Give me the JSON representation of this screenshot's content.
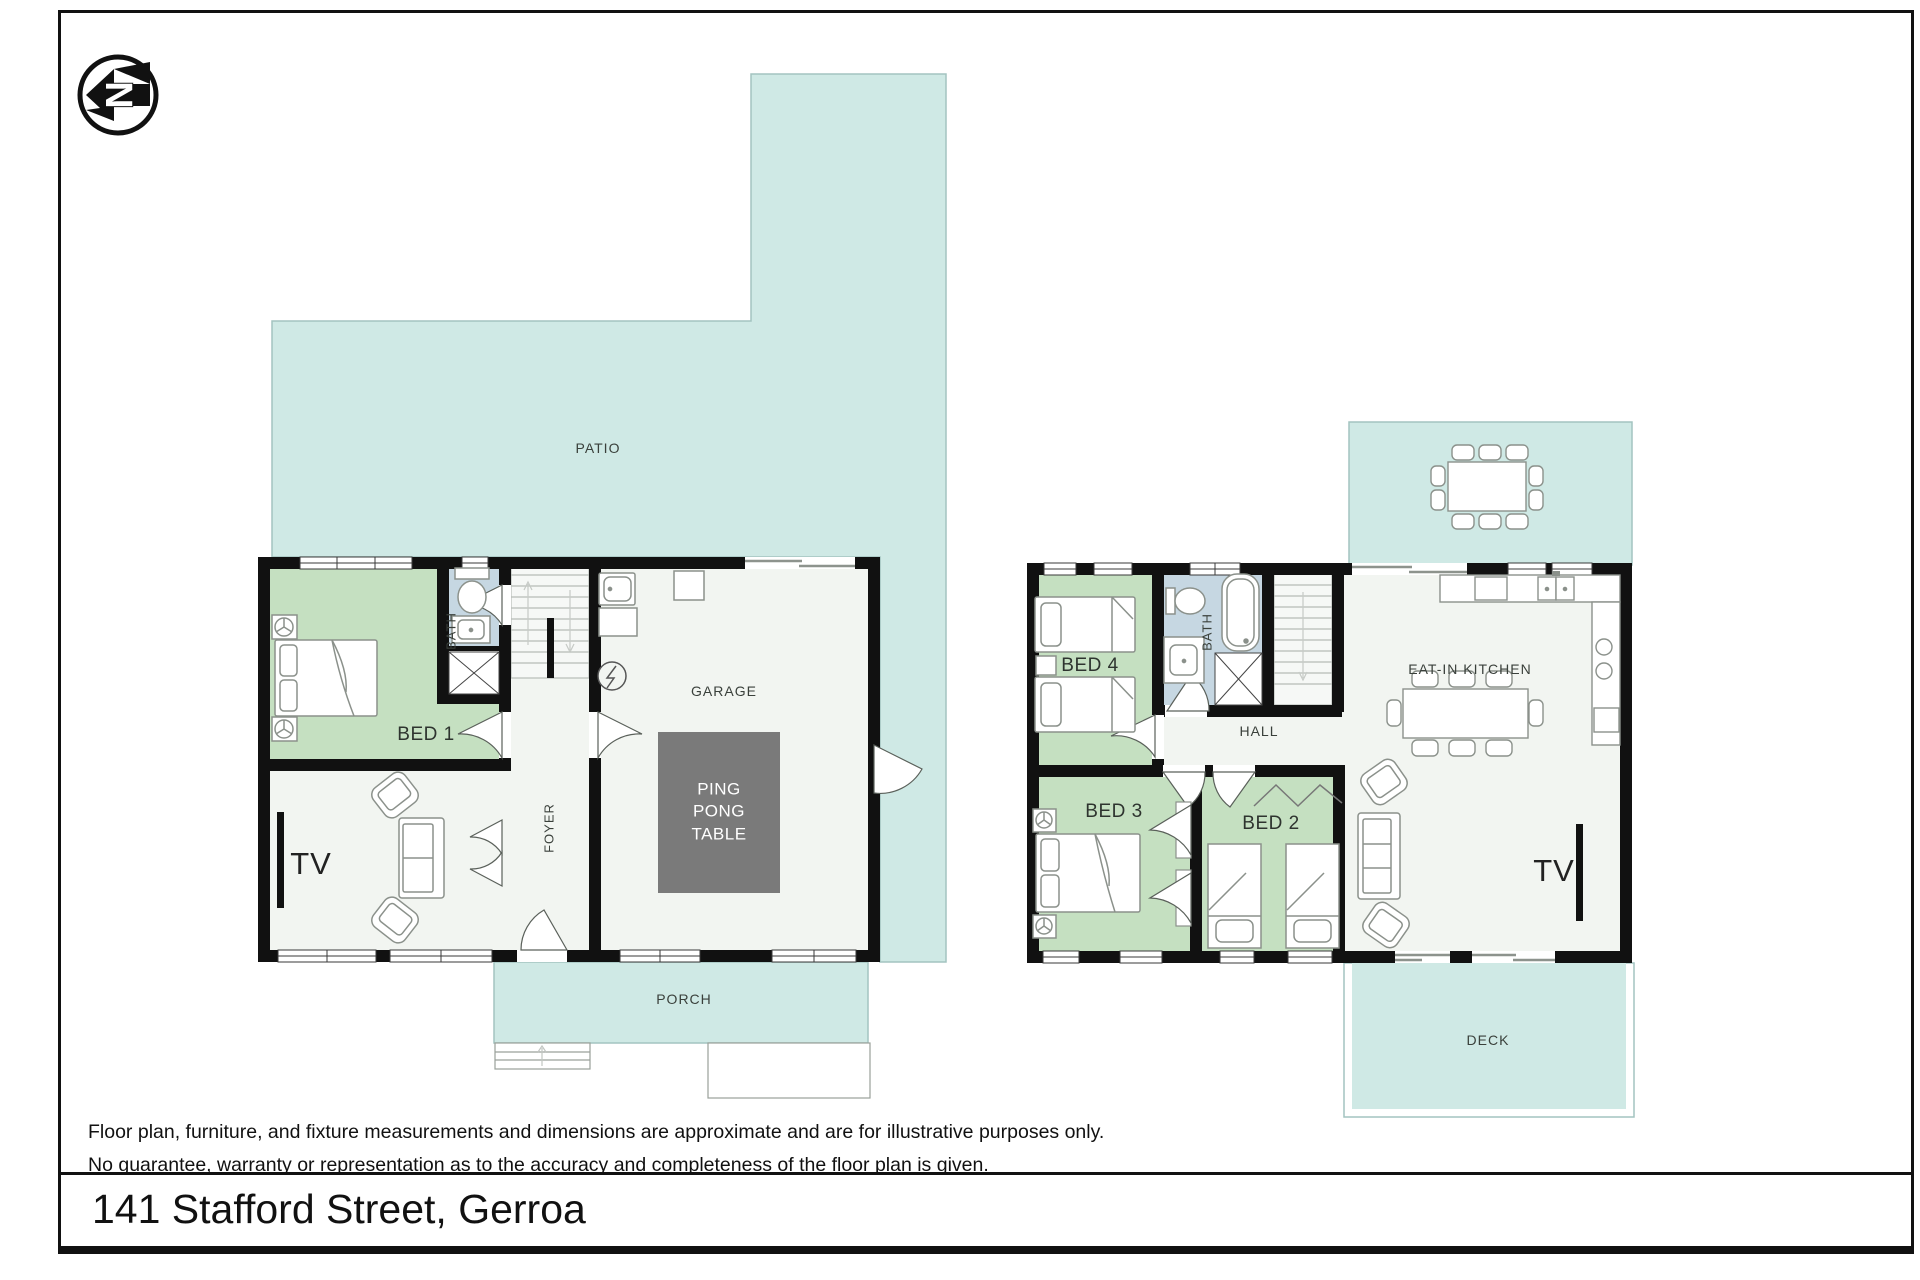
{
  "address": "141 Stafford Street, Gerroa",
  "disclaimer": {
    "line1": "Floor plan, furniture, and fixture measurements and dimensions are approximate and are for illustrative purposes only.",
    "line2": "No guarantee, warranty or representation as to the accuracy and completeness of the floor plan is given."
  },
  "compass": {
    "letter": "N"
  },
  "ground_floor": {
    "patio": "PATIO",
    "bed1": "BED 1",
    "bath": "BATH",
    "foyer": "FOYER",
    "garage": "GARAGE",
    "ping_pong_table": "PING PONG TABLE",
    "tv": "TV",
    "porch": "PORCH"
  },
  "upper_floor": {
    "bed4": "BED 4",
    "bath": "BATH",
    "hall": "HALL",
    "eat_in_kitchen": "EAT-IN KITCHEN",
    "bed3": "BED 3",
    "bed2": "BED 2",
    "tv": "TV",
    "deck": "DECK"
  },
  "colors": {
    "outdoor_teal": "#CFE9E5",
    "bedroom_green": "#C5E0C1",
    "bath_blue": "#C6D7E2",
    "floor_white": "#F2F5F1",
    "wall_black": "#111111",
    "ping_pong_gray": "#7A7A7A"
  }
}
